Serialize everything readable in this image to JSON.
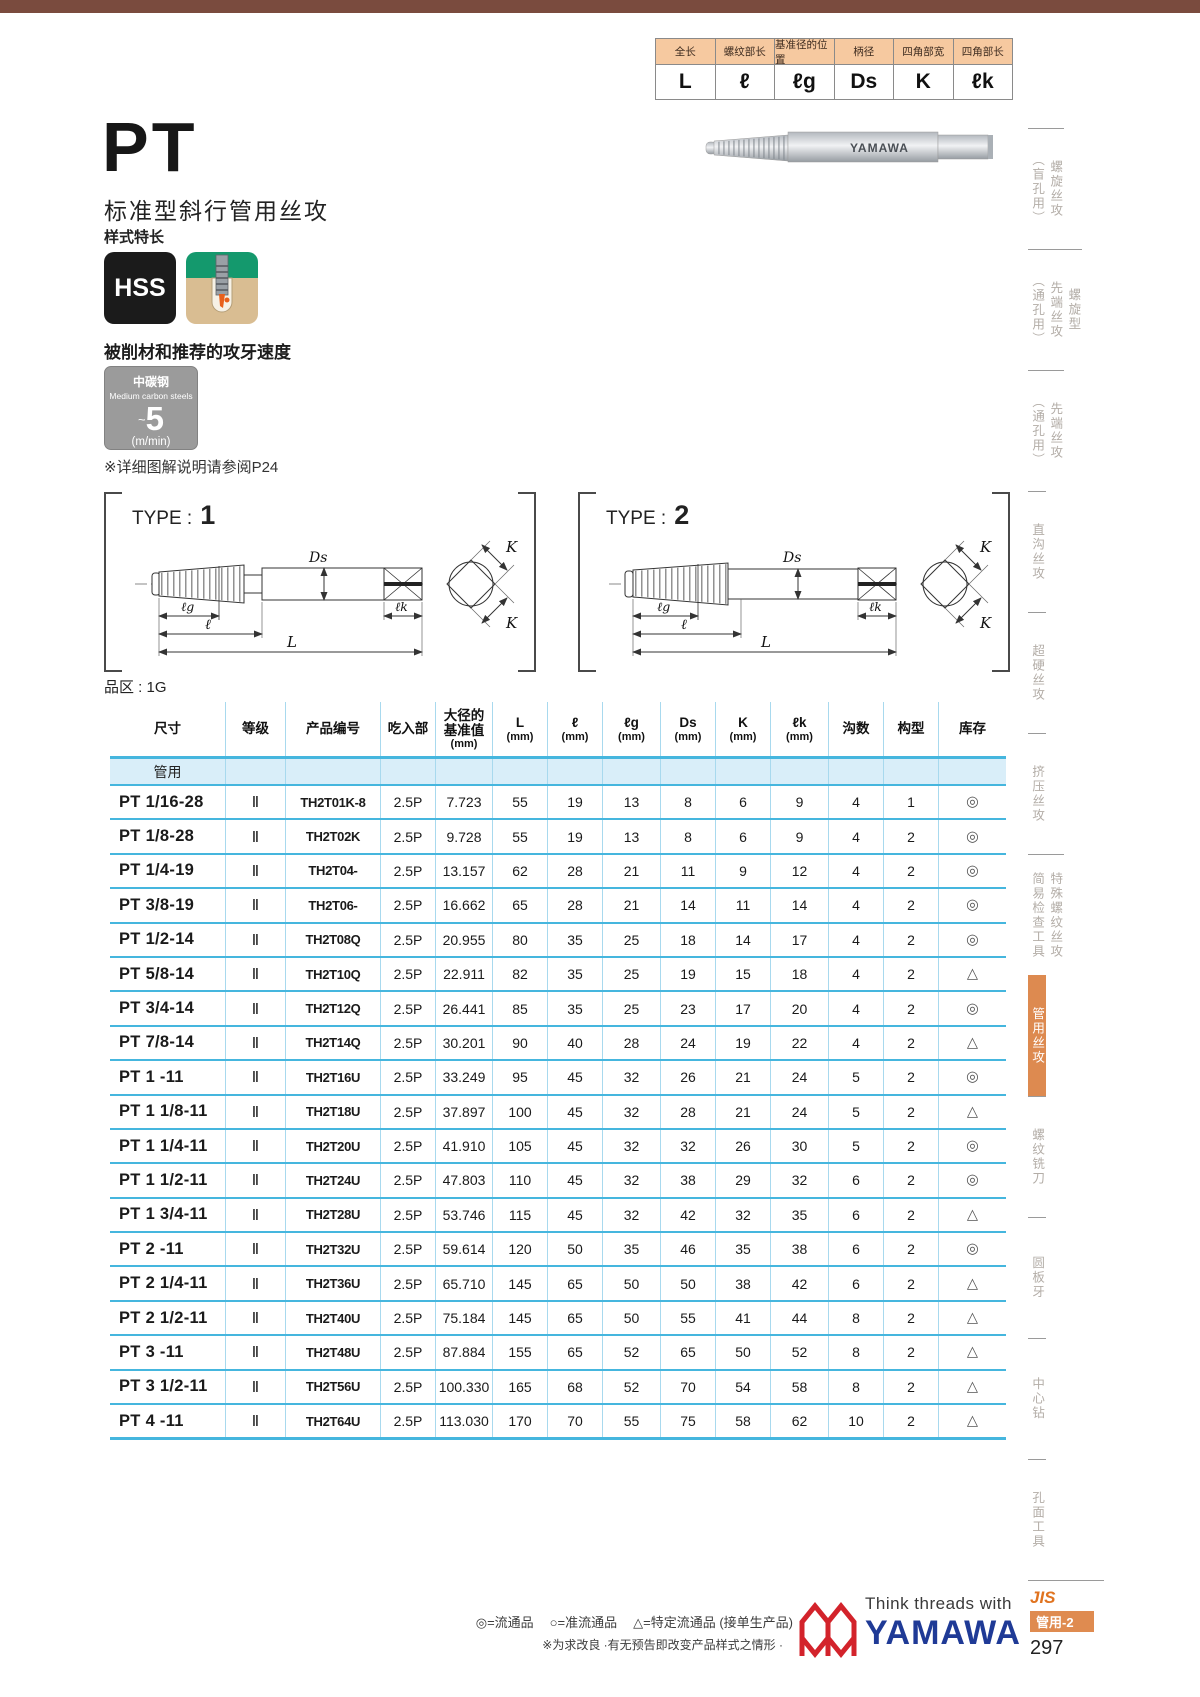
{
  "spec": {
    "columns": [
      {
        "label": "全长",
        "sym": "L"
      },
      {
        "label": "螺纹部长",
        "sym": "ℓ"
      },
      {
        "label": "基准径的位置",
        "sym": "ℓg"
      },
      {
        "label": "柄径",
        "sym": "Ds"
      },
      {
        "label": "四角部宽",
        "sym": "K"
      },
      {
        "label": "四角部长",
        "sym": "ℓk"
      }
    ]
  },
  "photo": {
    "brand": "YAMAWA"
  },
  "intro": {
    "title": "PT",
    "subtitle": "标准型斜行管用丝攻",
    "style_note": "样式特长",
    "hss": "HSS"
  },
  "speed": {
    "heading": "被削材和推荐的攻牙速度",
    "material_cn": "中碳钢",
    "material_en": "Medium carbon steels",
    "approx": "~",
    "value": "5",
    "unit": "(m/min)",
    "ref_note": "※详细图解说明请参阅P24"
  },
  "diagrams": {
    "type_label": "TYPE :",
    "type1_num": "1",
    "type2_num": "2",
    "dims": {
      "ds": "Ds",
      "lg": "ℓg",
      "l": "ℓ",
      "L": "L",
      "lk": "ℓk",
      "k": "K"
    },
    "series_note": "品区 : 1G"
  },
  "table": {
    "headers": [
      {
        "t": "尺寸",
        "u": ""
      },
      {
        "t": "等级",
        "u": ""
      },
      {
        "t": "产品编号",
        "u": ""
      },
      {
        "t": "吃入部",
        "u": ""
      },
      {
        "t": "大径的\n基准值",
        "u": "(mm)"
      },
      {
        "t": "L",
        "u": "(mm)"
      },
      {
        "t": "ℓ",
        "u": "(mm)"
      },
      {
        "t": "ℓg",
        "u": "(mm)"
      },
      {
        "t": "Ds",
        "u": "(mm)"
      },
      {
        "t": "K",
        "u": "(mm)"
      },
      {
        "t": "ℓk",
        "u": "(mm)"
      },
      {
        "t": "沟数",
        "u": ""
      },
      {
        "t": "构型",
        "u": ""
      },
      {
        "t": "库存",
        "u": ""
      }
    ],
    "group_label": "管用",
    "rows": [
      {
        "size": "PT 1/16-28",
        "grade": "Ⅱ",
        "code": "TH2T01K-8",
        "chamfer": "2.5P",
        "dia": "7.723",
        "L": "55",
        "l": "19",
        "lg": "13",
        "ds": "8",
        "k": "6",
        "lk": "9",
        "flutes": "4",
        "form": "1",
        "stock": "◎"
      },
      {
        "size": "PT 1/8-28",
        "grade": "Ⅱ",
        "code": "TH2T02K",
        "chamfer": "2.5P",
        "dia": "9.728",
        "L": "55",
        "l": "19",
        "lg": "13",
        "ds": "8",
        "k": "6",
        "lk": "9",
        "flutes": "4",
        "form": "2",
        "stock": "◎"
      },
      {
        "size": "PT 1/4-19",
        "grade": "Ⅱ",
        "code": "TH2T04-",
        "chamfer": "2.5P",
        "dia": "13.157",
        "L": "62",
        "l": "28",
        "lg": "21",
        "ds": "11",
        "k": "9",
        "lk": "12",
        "flutes": "4",
        "form": "2",
        "stock": "◎"
      },
      {
        "size": "PT 3/8-19",
        "grade": "Ⅱ",
        "code": "TH2T06-",
        "chamfer": "2.5P",
        "dia": "16.662",
        "L": "65",
        "l": "28",
        "lg": "21",
        "ds": "14",
        "k": "11",
        "lk": "14",
        "flutes": "4",
        "form": "2",
        "stock": "◎"
      },
      {
        "size": "PT 1/2-14",
        "grade": "Ⅱ",
        "code": "TH2T08Q",
        "chamfer": "2.5P",
        "dia": "20.955",
        "L": "80",
        "l": "35",
        "lg": "25",
        "ds": "18",
        "k": "14",
        "lk": "17",
        "flutes": "4",
        "form": "2",
        "stock": "◎"
      },
      {
        "size": "PT 5/8-14",
        "grade": "Ⅱ",
        "code": "TH2T10Q",
        "chamfer": "2.5P",
        "dia": "22.911",
        "L": "82",
        "l": "35",
        "lg": "25",
        "ds": "19",
        "k": "15",
        "lk": "18",
        "flutes": "4",
        "form": "2",
        "stock": "△"
      },
      {
        "size": "PT 3/4-14",
        "grade": "Ⅱ",
        "code": "TH2T12Q",
        "chamfer": "2.5P",
        "dia": "26.441",
        "L": "85",
        "l": "35",
        "lg": "25",
        "ds": "23",
        "k": "17",
        "lk": "20",
        "flutes": "4",
        "form": "2",
        "stock": "◎"
      },
      {
        "size": "PT 7/8-14",
        "grade": "Ⅱ",
        "code": "TH2T14Q",
        "chamfer": "2.5P",
        "dia": "30.201",
        "L": "90",
        "l": "40",
        "lg": "28",
        "ds": "24",
        "k": "19",
        "lk": "22",
        "flutes": "4",
        "form": "2",
        "stock": "△"
      },
      {
        "size": "PT 1 -11",
        "grade": "Ⅱ",
        "code": "TH2T16U",
        "chamfer": "2.5P",
        "dia": "33.249",
        "L": "95",
        "l": "45",
        "lg": "32",
        "ds": "26",
        "k": "21",
        "lk": "24",
        "flutes": "5",
        "form": "2",
        "stock": "◎"
      },
      {
        "size": "PT 1 1/8-11",
        "grade": "Ⅱ",
        "code": "TH2T18U",
        "chamfer": "2.5P",
        "dia": "37.897",
        "L": "100",
        "l": "45",
        "lg": "32",
        "ds": "28",
        "k": "21",
        "lk": "24",
        "flutes": "5",
        "form": "2",
        "stock": "△"
      },
      {
        "size": "PT 1 1/4-11",
        "grade": "Ⅱ",
        "code": "TH2T20U",
        "chamfer": "2.5P",
        "dia": "41.910",
        "L": "105",
        "l": "45",
        "lg": "32",
        "ds": "32",
        "k": "26",
        "lk": "30",
        "flutes": "5",
        "form": "2",
        "stock": "◎"
      },
      {
        "size": "PT 1 1/2-11",
        "grade": "Ⅱ",
        "code": "TH2T24U",
        "chamfer": "2.5P",
        "dia": "47.803",
        "L": "110",
        "l": "45",
        "lg": "32",
        "ds": "38",
        "k": "29",
        "lk": "32",
        "flutes": "6",
        "form": "2",
        "stock": "◎"
      },
      {
        "size": "PT 1 3/4-11",
        "grade": "Ⅱ",
        "code": "TH2T28U",
        "chamfer": "2.5P",
        "dia": "53.746",
        "L": "115",
        "l": "45",
        "lg": "32",
        "ds": "42",
        "k": "32",
        "lk": "35",
        "flutes": "6",
        "form": "2",
        "stock": "△"
      },
      {
        "size": "PT 2 -11",
        "grade": "Ⅱ",
        "code": "TH2T32U",
        "chamfer": "2.5P",
        "dia": "59.614",
        "L": "120",
        "l": "50",
        "lg": "35",
        "ds": "46",
        "k": "35",
        "lk": "38",
        "flutes": "6",
        "form": "2",
        "stock": "◎"
      },
      {
        "size": "PT 2 1/4-11",
        "grade": "Ⅱ",
        "code": "TH2T36U",
        "chamfer": "2.5P",
        "dia": "65.710",
        "L": "145",
        "l": "65",
        "lg": "50",
        "ds": "50",
        "k": "38",
        "lk": "42",
        "flutes": "6",
        "form": "2",
        "stock": "△"
      },
      {
        "size": "PT 2 1/2-11",
        "grade": "Ⅱ",
        "code": "TH2T40U",
        "chamfer": "2.5P",
        "dia": "75.184",
        "L": "145",
        "l": "65",
        "lg": "50",
        "ds": "55",
        "k": "41",
        "lk": "44",
        "flutes": "8",
        "form": "2",
        "stock": "△"
      },
      {
        "size": "PT 3 -11",
        "grade": "Ⅱ",
        "code": "TH2T48U",
        "chamfer": "2.5P",
        "dia": "87.884",
        "L": "155",
        "l": "65",
        "lg": "52",
        "ds": "65",
        "k": "50",
        "lk": "52",
        "flutes": "8",
        "form": "2",
        "stock": "△"
      },
      {
        "size": "PT 3 1/2-11",
        "grade": "Ⅱ",
        "code": "TH2T56U",
        "chamfer": "2.5P",
        "dia": "100.330",
        "L": "165",
        "l": "68",
        "lg": "52",
        "ds": "70",
        "k": "54",
        "lk": "58",
        "flutes": "8",
        "form": "2",
        "stock": "△"
      },
      {
        "size": "PT 4 -11",
        "grade": "Ⅱ",
        "code": "TH2T64U",
        "chamfer": "2.5P",
        "dia": "113.030",
        "L": "170",
        "l": "70",
        "lg": "55",
        "ds": "75",
        "k": "58",
        "lk": "62",
        "flutes": "10",
        "form": "2",
        "stock": "△"
      }
    ]
  },
  "sidebar": {
    "items": [
      {
        "label": "螺旋丝攻\n（盲孔用）"
      },
      {
        "label": "螺旋型\n先端丝攻\n（通孔用）"
      },
      {
        "label": "先端丝攻\n（通孔用）"
      },
      {
        "label": "直沟丝攻"
      },
      {
        "label": "超硬丝攻"
      },
      {
        "label": "挤压丝攻"
      },
      {
        "label": "特殊螺纹丝攻\n简易检查工具"
      },
      {
        "label": "管用丝攻",
        "active": true
      },
      {
        "label": "螺纹铣刀"
      },
      {
        "label": "圆板牙"
      },
      {
        "label": "中心钻"
      },
      {
        "label": "孔面工具"
      }
    ]
  },
  "footer": {
    "legend": [
      "◎=流通品",
      "○=准流通品",
      "△=特定流通品 (接单生产品)"
    ],
    "note": "※为求改良 ·有无预告即改变产品样式之情形 ·",
    "brand_slogan": "Think threads with",
    "brand_name": "YAMAWA",
    "standard": "JIS",
    "category": "管用-2",
    "page": "297"
  }
}
